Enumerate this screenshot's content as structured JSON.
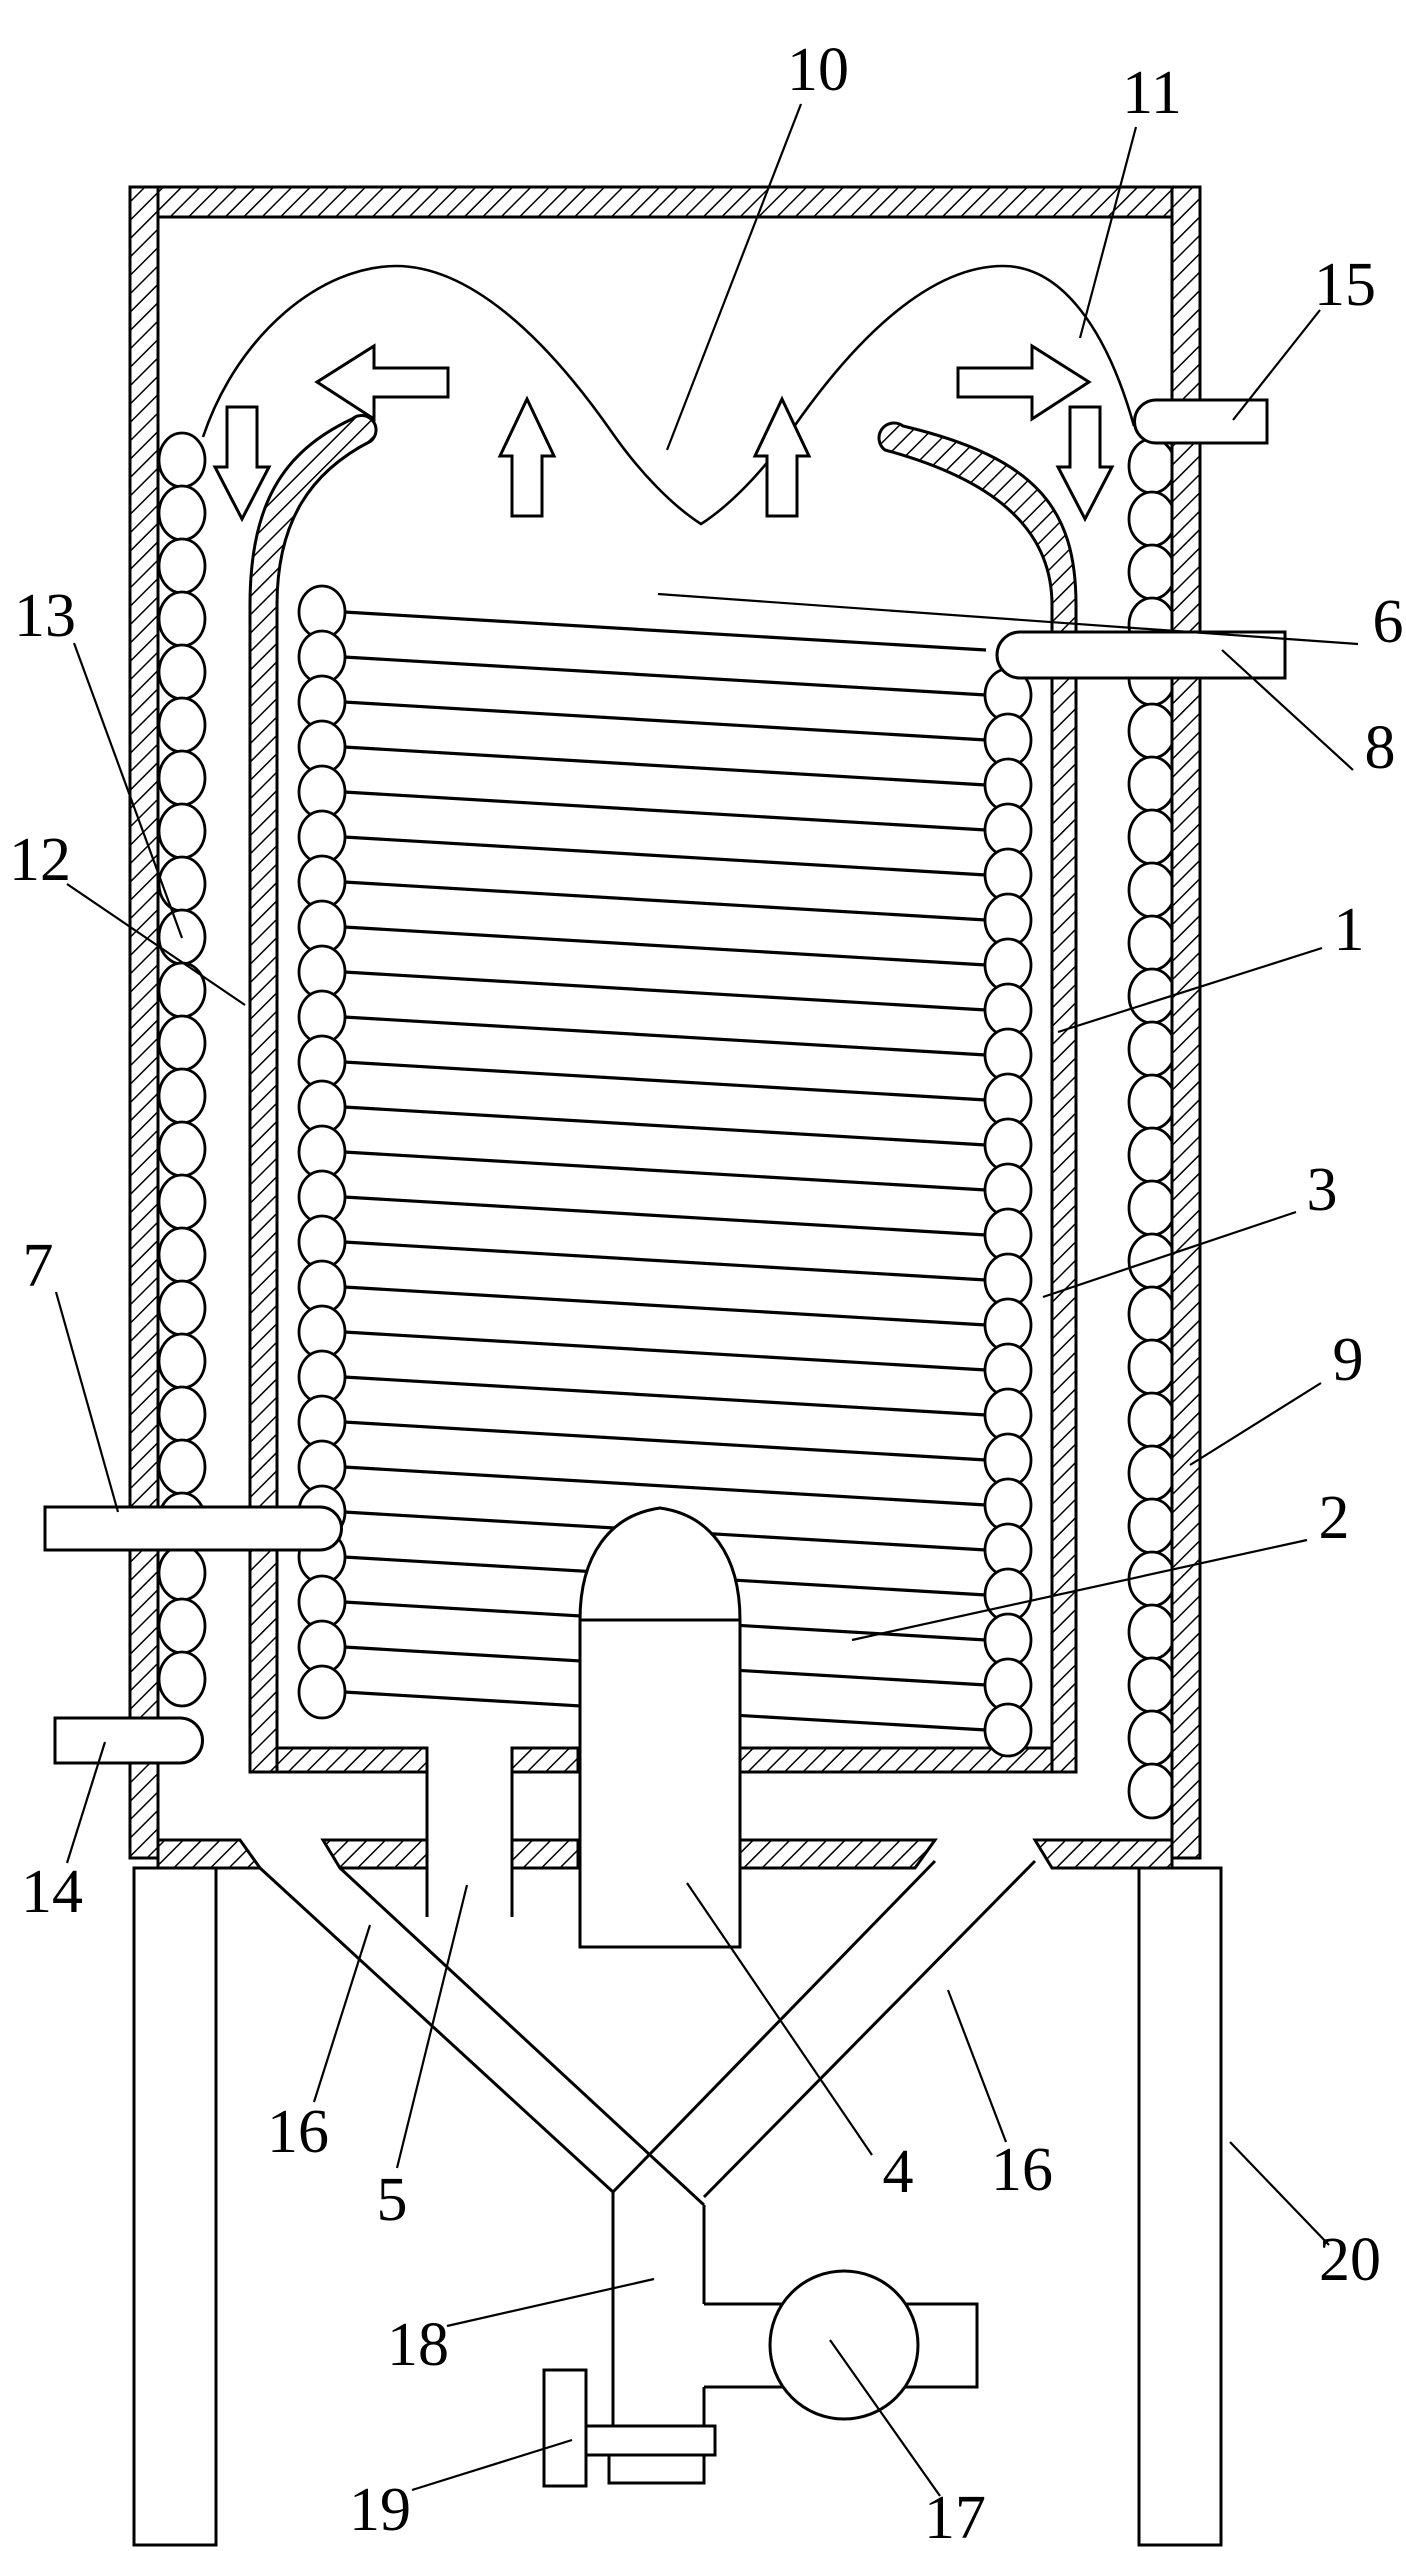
{
  "figure": {
    "background": "#ffffff",
    "ink": "#000000",
    "label_font_size": 62,
    "leader_stroke_width": 2.2
  },
  "callouts": [
    {
      "n": "1",
      "x": 1349,
      "y": 930,
      "x1": 1322,
      "y1": 948,
      "x2": 1058,
      "y2": 1032
    },
    {
      "n": "2",
      "x": 1334,
      "y": 1518,
      "x1": 1307,
      "y1": 1540,
      "x2": 852,
      "y2": 1640
    },
    {
      "n": "3",
      "x": 1322,
      "y": 1190,
      "x1": 1296,
      "y1": 1212,
      "x2": 1043,
      "y2": 1297
    },
    {
      "n": "4",
      "x": 898,
      "y": 2172,
      "x1": 872,
      "y1": 2155,
      "x2": 687,
      "y2": 1883
    },
    {
      "n": "5",
      "x": 392,
      "y": 2200,
      "x1": 397,
      "y1": 2168,
      "x2": 467,
      "y2": 1885
    },
    {
      "n": "6",
      "x": 1388,
      "y": 622,
      "x1": 1358,
      "y1": 644,
      "x2": 658,
      "y2": 594
    },
    {
      "n": "7",
      "x": 38,
      "y": 1266,
      "x1": 56,
      "y1": 1292,
      "x2": 118,
      "y2": 1512
    },
    {
      "n": "8",
      "x": 1380,
      "y": 748,
      "x1": 1353,
      "y1": 770,
      "x2": 1222,
      "y2": 650
    },
    {
      "n": "9",
      "x": 1348,
      "y": 1360,
      "x1": 1321,
      "y1": 1383,
      "x2": 1190,
      "y2": 1465
    },
    {
      "n": "10",
      "x": 818,
      "y": 70,
      "x1": 801,
      "y1": 104,
      "x2": 667,
      "y2": 450
    },
    {
      "n": "11",
      "x": 1152,
      "y": 93,
      "x1": 1136,
      "y1": 127,
      "x2": 1080,
      "y2": 338
    },
    {
      "n": "12",
      "x": 40,
      "y": 860,
      "x1": 67,
      "y1": 884,
      "x2": 245,
      "y2": 1005
    },
    {
      "n": "13",
      "x": 45,
      "y": 616,
      "x1": 74,
      "y1": 643,
      "x2": 182,
      "y2": 938
    },
    {
      "n": "14",
      "x": 52,
      "y": 1892,
      "x1": 67,
      "y1": 1863,
      "x2": 105,
      "y2": 1742
    },
    {
      "n": "15",
      "x": 1345,
      "y": 285,
      "x1": 1320,
      "y1": 310,
      "x2": 1233,
      "y2": 420
    },
    {
      "n": "16",
      "x": 298,
      "y": 2132,
      "x1": 314,
      "y1": 2102,
      "x2": 370,
      "y2": 1925
    },
    {
      "n": "16",
      "x": 1022,
      "y": 2170,
      "x1": 1006,
      "y1": 2142,
      "x2": 948,
      "y2": 1990
    },
    {
      "n": "17",
      "x": 955,
      "y": 2518,
      "x1": 940,
      "y1": 2496,
      "x2": 830,
      "y2": 2340
    },
    {
      "n": "18",
      "x": 418,
      "y": 2345,
      "x1": 447,
      "y1": 2326,
      "x2": 654,
      "y2": 2279
    },
    {
      "n": "19",
      "x": 380,
      "y": 2510,
      "x1": 412,
      "y1": 2490,
      "x2": 572,
      "y2": 2440
    },
    {
      "n": "20",
      "x": 1350,
      "y": 2260,
      "x1": 1329,
      "y1": 2245,
      "x2": 1230,
      "y2": 2142
    }
  ]
}
